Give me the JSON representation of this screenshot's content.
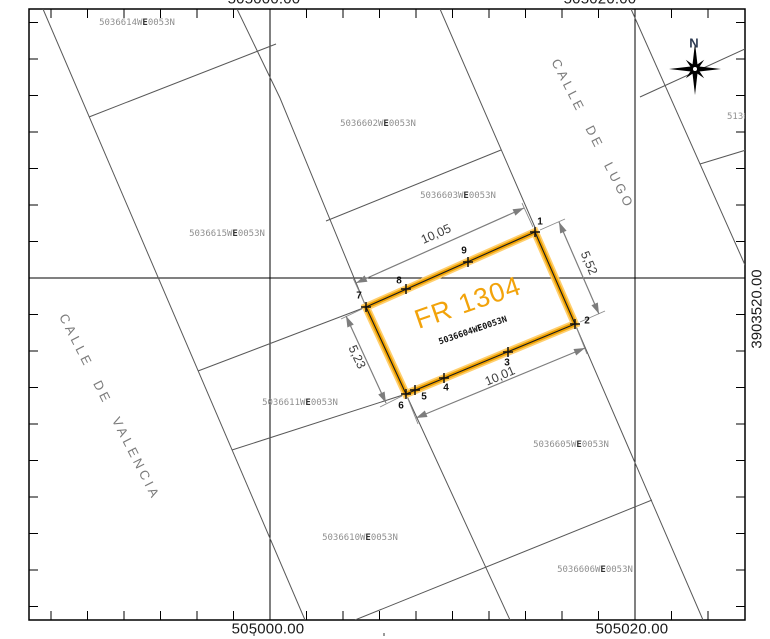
{
  "map": {
    "frame": {
      "x": 29,
      "y": 9,
      "width": 716,
      "height": 611
    },
    "grid": {
      "tick_spacing": 36.5,
      "verticals": [
        {
          "x": 270,
          "value": "505000.00"
        },
        {
          "x": 635,
          "value": "505020.00"
        }
      ],
      "horizontal": {
        "y": 278,
        "value": "3903520.00"
      }
    },
    "axis_labels": {
      "top_left": "505000.00",
      "top_right": "505020.00",
      "bottom_left": "505000.00",
      "bottom_right": "505020.00",
      "right": "3903520.00",
      "left": "3903520.00"
    },
    "axis_label_positions": {
      "top_left": {
        "x": 264,
        "y": -1
      },
      "top_right": {
        "x": 600,
        "y": -1
      },
      "bottom_left": {
        "x": 268,
        "y": 629
      },
      "bottom_right": {
        "x": 632,
        "y": 629
      },
      "right": {
        "x": 757,
        "y": 309
      },
      "left": {
        "x": -9,
        "y": 295
      }
    },
    "compass": {
      "label": "N",
      "cx": 695,
      "cy": 69,
      "label_x": 694,
      "label_y": 43
    },
    "streets": [
      {
        "name": "CALLE DE LUGO",
        "cx": 593,
        "cy": 134,
        "angle": 63
      },
      {
        "name": "CALLE DE VALENCIA",
        "cx": 110,
        "cy": 407,
        "angle": 63
      }
    ],
    "neighbor_parcels": [
      {
        "ref": "5036614WE0053N",
        "cx": 137,
        "cy": 23
      },
      {
        "ref": "5036602WE0053N",
        "cx": 378,
        "cy": 124
      },
      {
        "ref": "5036603WE0053N",
        "cx": 458,
        "cy": 196
      },
      {
        "ref": "5036615WE0053N",
        "cx": 227,
        "cy": 234
      },
      {
        "ref": "5036611WE0053N",
        "cx": 300,
        "cy": 403
      },
      {
        "ref": "5036605WE0053N",
        "cx": 571,
        "cy": 445
      },
      {
        "ref": "5036610WE0053N",
        "cx": 360,
        "cy": 538
      },
      {
        "ref": "5036606WE0053N",
        "cx": 595,
        "cy": 570
      }
    ],
    "clipped_parcel_ref": {
      "ref": "5136",
      "x": 727,
      "y": 106,
      "clip_width": 18
    },
    "boundary_lines": [
      {
        "name": "street-line-valencia-west",
        "pts": [
          [
            43,
            9
          ],
          [
            305,
            620
          ]
        ]
      },
      {
        "name": "street-line-valencia-east",
        "pts": [
          [
            237,
            9
          ],
          [
            280,
            98
          ],
          [
            366,
            307
          ],
          [
            406,
            394
          ],
          [
            510,
            620
          ]
        ]
      },
      {
        "name": "street-line-lugo-west",
        "pts": [
          [
            440,
            9
          ],
          [
            537,
            232
          ],
          [
            575,
            324
          ],
          [
            703,
            620
          ]
        ]
      },
      {
        "name": "street-line-lugo-east",
        "pts": [
          [
            631,
            9
          ],
          [
            745,
            265
          ]
        ]
      },
      {
        "name": "division-line-1",
        "pts": [
          [
            89,
            117
          ],
          [
            276,
            44
          ]
        ]
      },
      {
        "name": "division-line-2",
        "pts": [
          [
            326,
            221
          ],
          [
            501,
            150
          ]
        ]
      },
      {
        "name": "division-line-3",
        "pts": [
          [
            640,
            97
          ],
          [
            745,
            49
          ]
        ]
      },
      {
        "name": "division-line-4",
        "pts": [
          [
            700,
            164
          ],
          [
            746,
            150
          ]
        ]
      },
      {
        "name": "division-line-5",
        "pts": [
          [
            198,
            371
          ],
          [
            366,
            307
          ]
        ]
      },
      {
        "name": "division-line-6",
        "pts": [
          [
            232,
            450
          ],
          [
            406,
            394
          ]
        ]
      },
      {
        "name": "division-line-7",
        "pts": [
          [
            355,
            620
          ],
          [
            652,
            500
          ]
        ]
      }
    ],
    "stray_marks": [
      [
        253,
        633
      ],
      [
        383,
        633
      ]
    ]
  },
  "subject_parcel": {
    "label": "FR 1304",
    "ref": "5036604WE0053N",
    "highlight_color": "#F0A202",
    "glow_color": "#FFCC66",
    "label_pos": {
      "cx": 468,
      "cy": 303,
      "angle": -19
    },
    "ref_pos": {
      "cx": 473,
      "cy": 331,
      "angle": -19
    },
    "outline": [
      [
        366,
        307
      ],
      [
        535,
        232
      ],
      [
        575,
        324
      ],
      [
        406,
        394
      ]
    ],
    "vertices": [
      {
        "n": "1",
        "x": 535,
        "y": 232,
        "lx": 540,
        "ly": 222
      },
      {
        "n": "2",
        "x": 575,
        "y": 324,
        "lx": 587,
        "ly": 321
      },
      {
        "n": "3",
        "x": 508,
        "y": 352,
        "lx": 507,
        "ly": 363
      },
      {
        "n": "4",
        "x": 444,
        "y": 378,
        "lx": 446,
        "ly": 388
      },
      {
        "n": "5",
        "x": 415,
        "y": 390,
        "lx": 424,
        "ly": 397
      },
      {
        "n": "6",
        "x": 406,
        "y": 394,
        "lx": 401,
        "ly": 406
      },
      {
        "n": "7",
        "x": 366,
        "y": 307,
        "lx": 359,
        "ly": 296
      },
      {
        "n": "8",
        "x": 406,
        "y": 289,
        "lx": 399,
        "ly": 281
      },
      {
        "n": "9",
        "x": 468,
        "y": 262,
        "lx": 464,
        "ly": 251
      }
    ],
    "dimensions": [
      {
        "label": "10,05",
        "x1": 356,
        "y1": 283,
        "x2": 524,
        "y2": 208,
        "lx": 436,
        "ly": 234,
        "angle": -24
      },
      {
        "label": "5,52",
        "x1": 559,
        "y1": 222,
        "x2": 599,
        "y2": 314,
        "lx": 589,
        "ly": 263,
        "angle": 67
      },
      {
        "label": "5,23",
        "x1": 346,
        "y1": 316,
        "x2": 386,
        "y2": 403,
        "lx": 357,
        "ly": 357,
        "angle": 65
      },
      {
        "label": "10,01",
        "x1": 416,
        "y1": 418,
        "x2": 585,
        "y2": 348,
        "lx": 500,
        "ly": 376,
        "angle": -23
      }
    ],
    "extension_lines": [
      [
        [
          364,
          302
        ],
        [
          353,
          278
        ]
      ],
      [
        [
          533,
          227
        ],
        [
          522,
          203
        ]
      ],
      [
        [
          540,
          230
        ],
        [
          565,
          219
        ]
      ],
      [
        [
          580,
          322
        ],
        [
          605,
          311
        ]
      ],
      [
        [
          362,
          309
        ],
        [
          341,
          319
        ]
      ],
      [
        [
          402,
          396
        ],
        [
          380,
          407
        ]
      ],
      [
        [
          408,
          399
        ],
        [
          418,
          424
        ]
      ],
      [
        [
          577,
          329
        ],
        [
          587,
          354
        ]
      ]
    ]
  }
}
